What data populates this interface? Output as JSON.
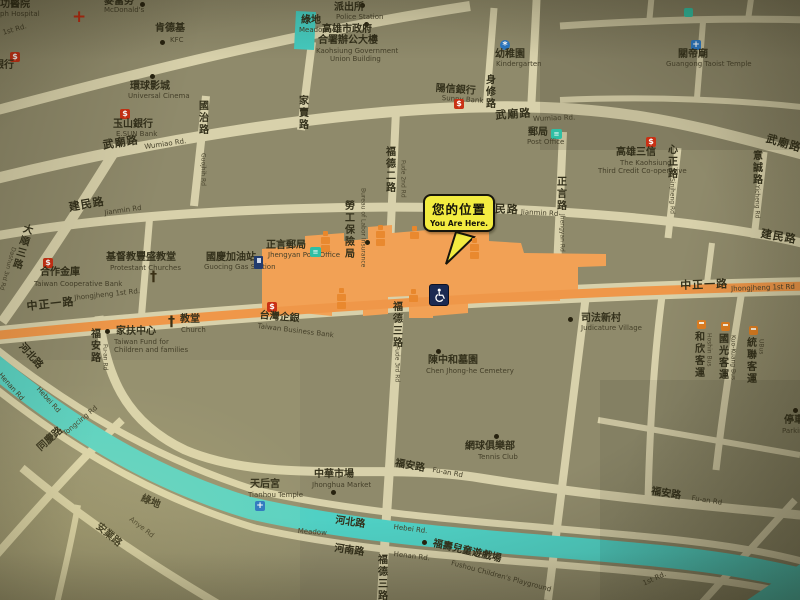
{
  "callout": {
    "zh": "您的位置",
    "en": "You Are Here."
  },
  "icon_glyphs": {
    "bank": "$",
    "post_office": "≡",
    "church_cross": "†",
    "hospital_cross": "+",
    "kindergarten": "*",
    "temple": "+",
    "gas_pump": "gas-pump",
    "bus": "bus",
    "wheelchair": "wheelchair"
  },
  "colors": {
    "road": "#d8d1ab",
    "block": "#8f8a6b",
    "main_road_orange": "#ef9749",
    "station_orange": "#f2a155",
    "greenway_teal": "#4fd0c4",
    "callout_yellow": "#f3ec40"
  },
  "pois": {
    "st_joseph_hospital": {
      "zh": "功醫院",
      "en": "ph Hospital"
    },
    "mcdonalds": {
      "zh": "麥當勞",
      "en": "McDonald's"
    },
    "kfc": {
      "zh": "肯德基",
      "en": "KFC"
    },
    "universal_cinema": {
      "zh": "環球影城",
      "en": "Universal Cinema"
    },
    "esun_bank": {
      "zh": "玉山銀行",
      "en": "E.SUN Bank"
    },
    "edge_bank": {
      "zh": "銀行"
    },
    "police_station": {
      "zh": "派出所",
      "en": "Police Station"
    },
    "meadow_top": {
      "zh": "綠地",
      "en": "Meadow"
    },
    "kcg_building": {
      "zh1": "高雄市政府",
      "zh2": "合署辦公大樓",
      "en1": "Kaohsiung Government",
      "en2": "Union Building"
    },
    "kindergarten_north": {
      "zh": "幼稚園",
      "en": "Kindergarten"
    },
    "guangong_temple": {
      "zh": "關帝廟",
      "en": "Guangong Taoist Temple"
    },
    "sunny_bank": {
      "zh": "陽信銀行",
      "en": "Sunny Bank"
    },
    "post_office_north": {
      "zh": "郵局",
      "en": "Post Office"
    },
    "kaohsiung_third_credit": {
      "zh": "高雄三信",
      "en1": "The Kaohsiung",
      "en2": "Third Credit Co-operative"
    },
    "kindergarten_mid": {
      "zh": "幼稚園",
      "en": "Kindergarten"
    },
    "labor_insurance_bureau": {
      "zh": "勞工保險局",
      "en": "Bureau of Labor Insurance"
    },
    "cooperative_bank": {
      "zh": "合作金庫",
      "en": "Taiwan Cooperative Bank"
    },
    "protestant_churches": {
      "zh": "基督教豐盛教堂",
      "en": "Protestant Churches"
    },
    "guocing_gas_station": {
      "zh": "國慶加油站",
      "en": "Guocing Gas Station"
    },
    "jhengyan_post_office": {
      "zh": "正言郵局",
      "en": "Jhengyan Post Office"
    },
    "church": {
      "zh": "教堂",
      "en": "Church"
    },
    "family_fund": {
      "zh": "家扶中心",
      "en1": "Taiwan Fund for",
      "en2": "Children and families"
    },
    "taiwan_business_bank": {
      "zh": "台灣企銀",
      "en": "Taiwan Business Bank"
    },
    "judicature_village": {
      "zh": "司法新村",
      "en": "Judicature Village"
    },
    "hoshin_bus": {
      "zh": "和欣客運",
      "en": "Hoshin Bus"
    },
    "kuokuang_bus": {
      "zh": "國光客運",
      "en": "Kuo-Kuang Bus"
    },
    "ubus": {
      "zh": "統聯客運",
      "en": "UBus"
    },
    "chen_cemetery": {
      "zh": "陳中和墓園",
      "en": "Chen Jhong-he Cemetery"
    },
    "tennis_club": {
      "zh": "網球俱樂部",
      "en": "Tennis Club"
    },
    "tianhou_temple": {
      "zh": "天后宮",
      "en": "Tianhou Temple"
    },
    "jhonghua_market": {
      "zh": "中華市場",
      "en": "Jhonghua Market"
    },
    "meadow_band": {
      "zh": "綠地",
      "en": "Meadow"
    },
    "fushou_playground": {
      "zh": "福壽兒童遊戲場",
      "en": "Fushou Children's Playground"
    },
    "parking_lot": {
      "zh": "停車場",
      "en": "Parking lot"
    }
  },
  "roads": {
    "first_rd_nw": {
      "en": "1st Rd."
    },
    "wumiao_w": {
      "zh": "武廟路",
      "en": "Wumiao Rd."
    },
    "wumiao_c": {
      "zh": "武廟路",
      "en": "Wumiao Rd."
    },
    "wumiao_e": {
      "zh": "武廟路"
    },
    "guojhih": {
      "zh": "國治路",
      "en": "Guojhih Rd"
    },
    "jiamai": {
      "zh": "家賣路"
    },
    "shensiou": {
      "zh": "身修路"
    },
    "jianmin_w": {
      "zh": "建民路",
      "en": "Jianmin Rd"
    },
    "jianmin_c": {
      "zh": "建民路",
      "en": "Jianmin Rd"
    },
    "jianmin_e": {
      "zh": "建民路"
    },
    "dashun_3rd": {
      "zh": "大順三路",
      "en": "Dashun 3rd Rd"
    },
    "jhengyan": {
      "zh": "正言路",
      "en": "Jhengyan Rd"
    },
    "sinjheng": {
      "zh": "心正路",
      "en": "Sinjheng Rd"
    },
    "yicheng": {
      "zh": "意誠路",
      "en": "Yicheng Rd"
    },
    "fude_2nd": {
      "zh": "福德二路",
      "en": "Fude 2nd Rd"
    },
    "fude_3rd": {
      "zh": "福德三路",
      "en": "Fude 3rd Rd"
    },
    "fude_3rd_s": {
      "zh": "福德三路"
    },
    "jhongjheng_w": {
      "zh": "中正一路",
      "en": "Jhongjheng 1st Rd."
    },
    "jhongjheng_e": {
      "zh": "中正一路",
      "en": "Jhongjheng 1st Rd"
    },
    "fuan_w": {
      "zh": "福安路",
      "en": "Fu-an Rd"
    },
    "fuan_c": {
      "zh": "福安路",
      "en": "Fu-an Rd"
    },
    "fuan_e": {
      "zh": "福安路",
      "en": "Fu-an Rd"
    },
    "hebei_w": {
      "zh": "河北路",
      "en": "Hebei Rd"
    },
    "hebei_s": {
      "zh": "河北路",
      "en": "Hebei Rd."
    },
    "henan_w": {
      "en": "Henan Rd"
    },
    "henan_s": {
      "zh": "河南路",
      "en": "Henan Rd."
    },
    "tongcing": {
      "zh": "同慶路",
      "en": "Tongcing Rd"
    },
    "anye": {
      "zh": "安業路",
      "en": "Anye Rd"
    },
    "first_rd_se": {
      "en": "1st Rd."
    }
  }
}
